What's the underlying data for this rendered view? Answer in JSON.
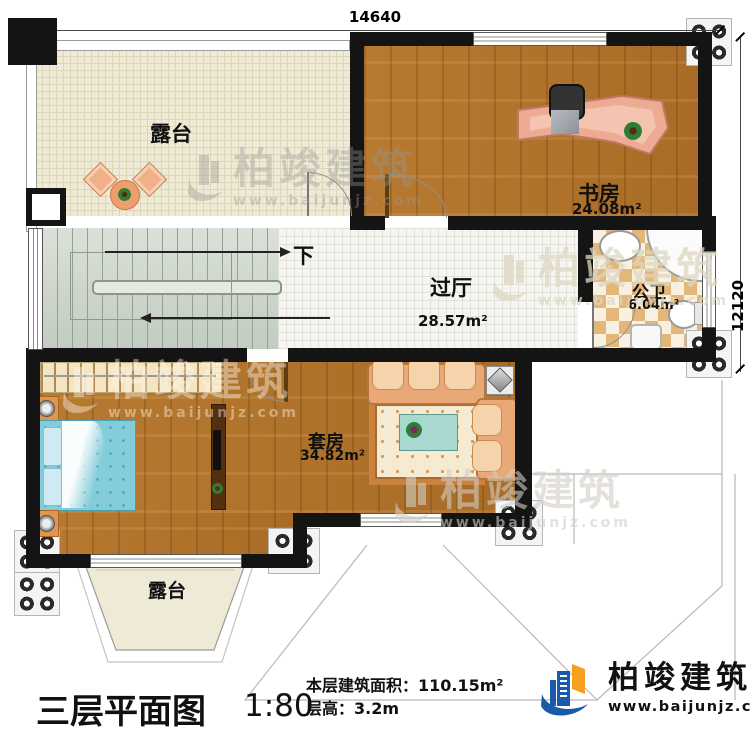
{
  "dimensions": {
    "top": "14640",
    "right": "12120"
  },
  "rooms": {
    "terrace_top": {
      "name": "露台"
    },
    "study": {
      "name": "书房",
      "area": "24.08m²"
    },
    "hallway": {
      "name": "过厅",
      "area": "28.57m²"
    },
    "bathroom": {
      "name": "公卫",
      "area": "6.04m²"
    },
    "suite": {
      "name": "套房",
      "area": "34.82m²"
    },
    "terrace_bottom": {
      "name": "露台"
    }
  },
  "stairs": {
    "down_label": "下"
  },
  "watermark": {
    "brand": "柏竣建筑",
    "url": "www.baijunjz.com"
  },
  "footer": {
    "title": "三层平面图",
    "scale": "1:80",
    "area_label": "本层建筑面积：",
    "area_value": "110.15m²",
    "height_label": "层高：",
    "height_value": "3.2m",
    "brand": "柏竣建筑",
    "url": "www.baijunjz.com"
  },
  "colors": {
    "wall": "#141414",
    "wood": "#b1752e",
    "terrace": "#efead6",
    "tile": "#f5f5f1",
    "checker": "#e3b778",
    "bed": "#83ccda",
    "sofa": "#e9a877",
    "logo_blue": "#1a5aa8",
    "logo_orange": "#f5a01e"
  }
}
